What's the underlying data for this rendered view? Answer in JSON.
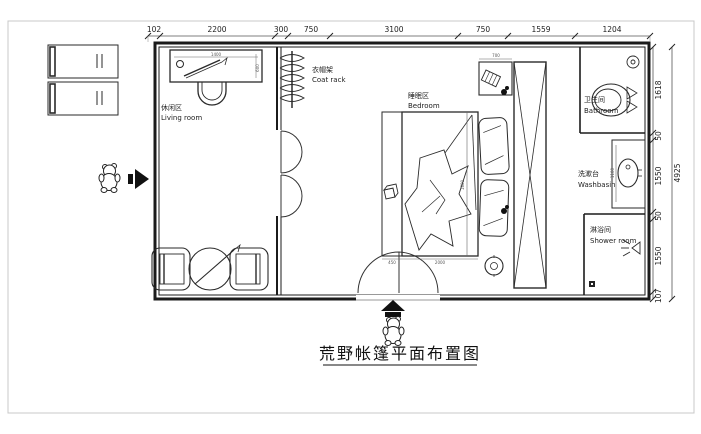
{
  "title": "荒野帐篷平面布置图",
  "dims": {
    "top": [
      "102",
      "2200",
      "300",
      "750",
      "3100",
      "750",
      "1559",
      "1204"
    ],
    "right": [
      "1618",
      "50",
      "1550",
      "50",
      "1550",
      "107"
    ],
    "right_total": "4925",
    "desk_width": "1400",
    "desk_depth": "600",
    "bed_width": "2000",
    "bed_length": "1800",
    "bench_width": "450",
    "nightstand_width": "700",
    "basin_counter": "1100"
  },
  "rooms": {
    "living": {
      "cn": "休闲区",
      "en": "Living room"
    },
    "coat": {
      "cn": "衣帽架",
      "en": "Coat rack"
    },
    "bedroom": {
      "cn": "睡眠区",
      "en": "Bedroom"
    },
    "bathroom": {
      "cn": "卫生间",
      "en": "Bathroom"
    },
    "washbasin": {
      "cn": "洗漱台",
      "en": "Washbasin"
    },
    "shower": {
      "cn": "淋浴间",
      "en": "Shower room"
    }
  },
  "colors": {
    "wall": "#1b1b1b",
    "furniture": "#2a2a2a",
    "dimension": "#444444",
    "frame": "#c8c8c8",
    "background": "#ffffff"
  }
}
